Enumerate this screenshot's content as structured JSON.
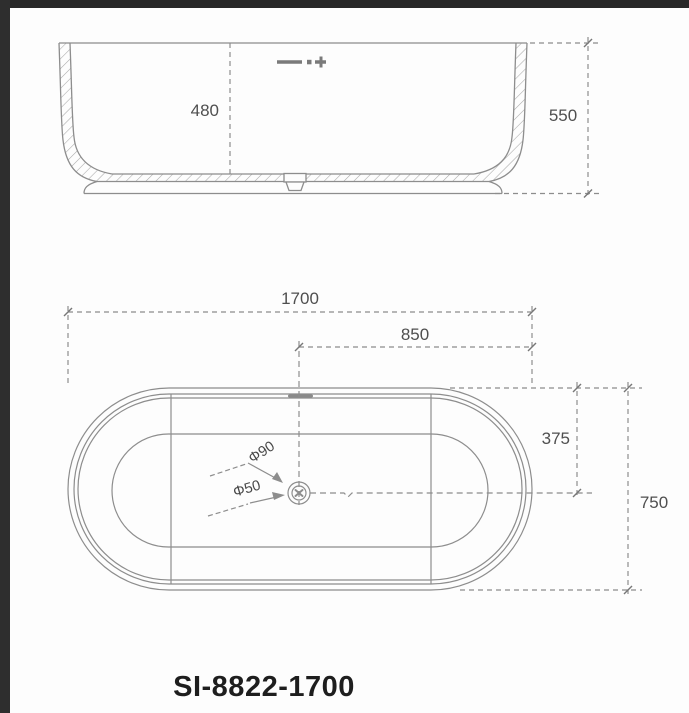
{
  "model_label": "SI-8822-1700",
  "section_view": {
    "dims": {
      "inner_depth": "480",
      "overall_height": "550"
    }
  },
  "plan_view": {
    "dims": {
      "overall_length": "1700",
      "center_to_end": "850",
      "center_to_side": "375",
      "overall_width": "750"
    },
    "drain": {
      "outer_diameter": "Φ90",
      "inner_diameter": "Φ50"
    }
  },
  "colors": {
    "line": "#8d8d8d",
    "hatch": "#a8a8a8",
    "dim_text": "#4f4f4f",
    "model_text": "#1e1e1e",
    "border": "#2b2b2b"
  }
}
